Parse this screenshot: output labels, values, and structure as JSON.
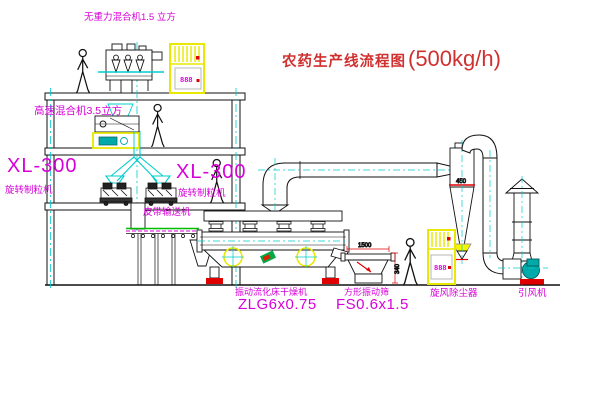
{
  "title": {
    "main": "农药生产线流程图",
    "capacity": "(500kg/h)"
  },
  "equipment": {
    "gravity_mixer": "无重力混合机1.5 立方",
    "high_speed_mixer": "高速混合机3.5立方",
    "granulator_left": {
      "model": "XL-300",
      "name": "旋转制粒机"
    },
    "granulator_mid": {
      "model": "XL-300",
      "name": "旋转制粒机"
    },
    "belt_conveyor": "皮带输送机",
    "dryer": {
      "name": "振动流化床干燥机",
      "model": "ZLG6x0.75"
    },
    "sieve": {
      "name": "方形振动筛",
      "model": "FS0.6x1.5"
    },
    "cyclone": "旋风除尘器",
    "fan": "引风机"
  },
  "dimensions": {
    "sieve_length": "1500",
    "sieve_height": "340",
    "cyclone_marking": "450"
  },
  "cabinet": {
    "display": "888"
  },
  "colors": {
    "label": "#d800d8",
    "title": "#d03030",
    "outline": "#111111",
    "highlight": "#e8e800",
    "centerline": "#00cccc",
    "status_red": "#e00000",
    "machine_teal": "#00aaaa"
  }
}
